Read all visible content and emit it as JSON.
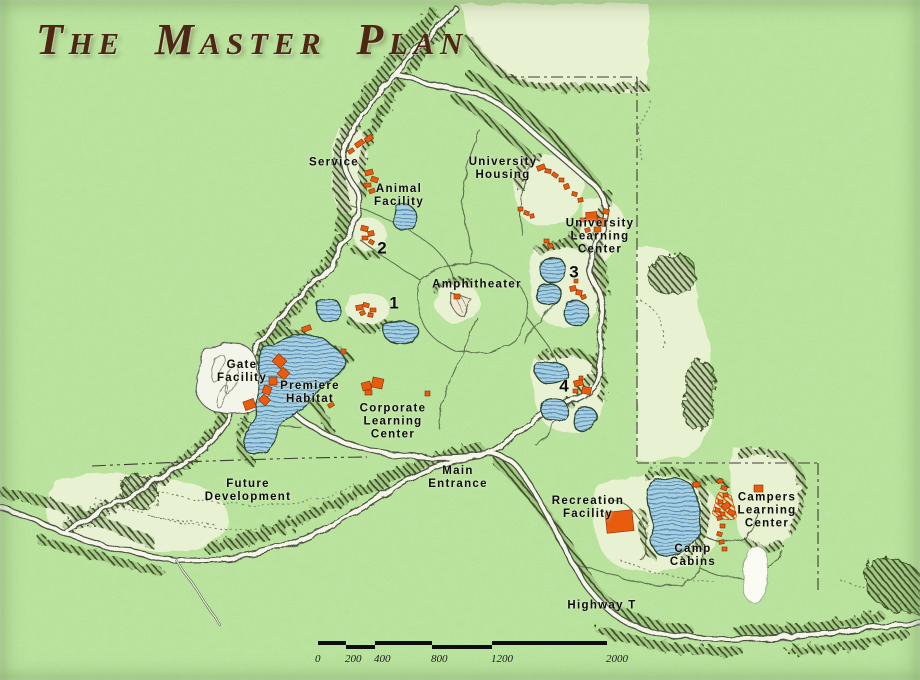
{
  "title": "The Master Plan",
  "labels": {
    "service": "Service",
    "animal_facility": "Animal\nFacility",
    "university_housing": "University\nHousing",
    "university_learning_center": "University\nLearning\nCenter",
    "amphitheater": "Amphitheater",
    "area_1": "1",
    "area_2": "2",
    "area_3": "3",
    "area_4": "4",
    "gate_facility": "Gate\nFacility",
    "premiere_habitat": "Premiere\nHabitat",
    "corporate_learning_center": "Corporate\nLearning\nCenter",
    "future_development": "Future\nDevelopment",
    "main_entrance": "Main\nEntrance",
    "recreation_facility": "Recreation\nFacility",
    "campers_learning_center": "Campers\nLearning\nCenter",
    "camp_cabins": "Camp\nCabins",
    "highway_t": "Highway T"
  },
  "scale_bar": {
    "labels": [
      "0",
      "200",
      "400",
      "800",
      "1200",
      "2000"
    ]
  },
  "colors": {
    "background": "#b2df93",
    "open_field": "#e9f1d3",
    "water": "#a6cfe2",
    "water_stripe": "#5d90b2",
    "building": "#e95b0f",
    "forest": "#3c5026",
    "road_fill": "#f5f5e8",
    "road_casing": "#4a5243",
    "title_text": "#4b2714",
    "label_text": "#0c0c0c"
  }
}
